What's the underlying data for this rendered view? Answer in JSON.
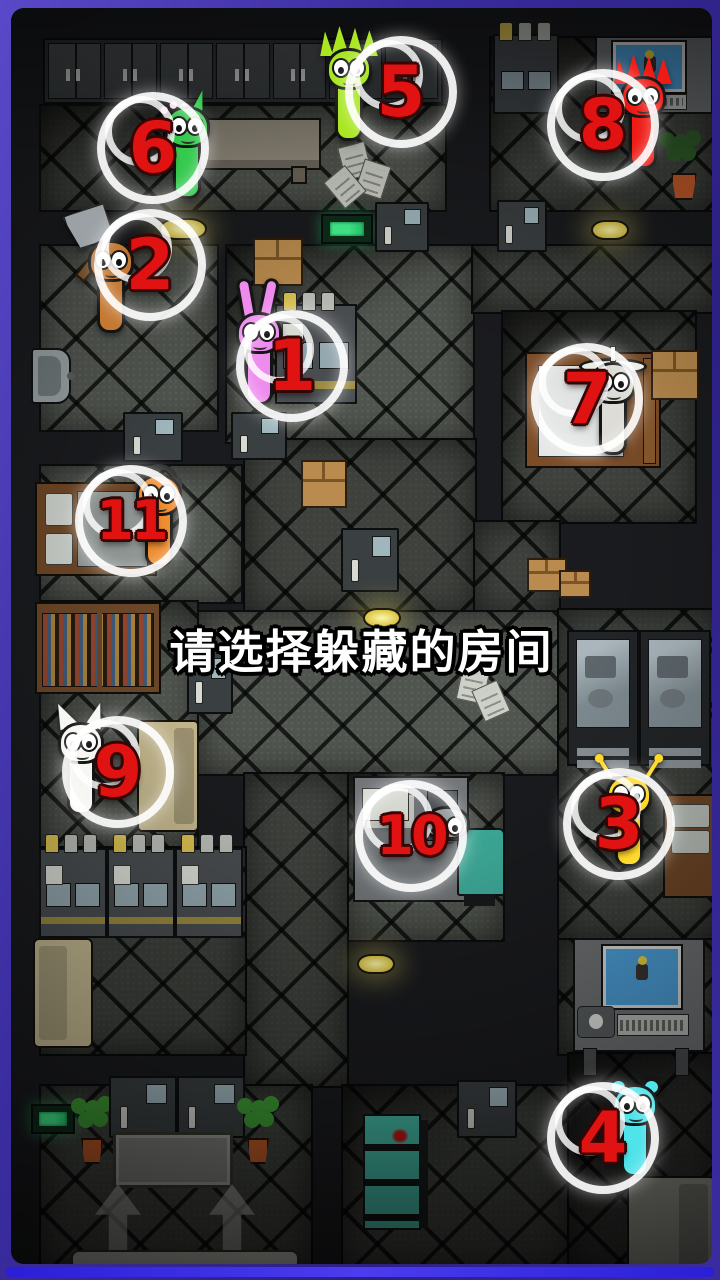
{
  "prompt": {
    "text": "请选择躲藏的房间"
  },
  "ui_colors": {
    "number": "#e01212",
    "selection_ring": "#ffffff",
    "frame_border": "#4534b4",
    "bottom_bar": "#3a2ce8",
    "exit_sign": "#45f792",
    "ceiling_lamp": "#ecd94e"
  },
  "markers": [
    {
      "number": "1",
      "character": {
        "type": "bunny",
        "color": "#ee8cee",
        "x": 222,
        "y": 304
      },
      "ring": {
        "x": 281,
        "y": 358
      }
    },
    {
      "number": "2",
      "character": {
        "type": "axe",
        "color": "#c47832",
        "x": 74,
        "y": 232
      },
      "ring": {
        "x": 139,
        "y": 257
      }
    },
    {
      "number": "3",
      "character": {
        "type": "antennae",
        "color": "#ffd928",
        "x": 592,
        "y": 766
      },
      "ring": {
        "x": 608,
        "y": 816
      }
    },
    {
      "number": "4",
      "character": {
        "type": "bear",
        "color": "#4fe3ea",
        "x": 598,
        "y": 1076
      },
      "ring": {
        "x": 592,
        "y": 1130
      }
    },
    {
      "number": "5",
      "character": {
        "type": "spiky",
        "color": "#a8e620",
        "x": 312,
        "y": 40
      },
      "ring": {
        "x": 390,
        "y": 84
      }
    },
    {
      "number": "6",
      "character": {
        "type": "flower",
        "color": "#35c94e",
        "x": 150,
        "y": 98
      },
      "ring": {
        "x": 142,
        "y": 140
      }
    },
    {
      "number": "7",
      "character": {
        "type": "hat",
        "color": "#dddcd6",
        "x": 576,
        "y": 354
      },
      "ring": {
        "x": 576,
        "y": 391
      }
    },
    {
      "number": "8",
      "character": {
        "type": "spiky",
        "color": "#ee1b15",
        "x": 606,
        "y": 68
      },
      "ring": {
        "x": 592,
        "y": 117
      }
    },
    {
      "number": "9",
      "character": {
        "type": "cat",
        "color": "#f6f6f2",
        "x": 44,
        "y": 714
      },
      "ring": {
        "x": 107,
        "y": 764
      }
    },
    {
      "number": "10",
      "character": {
        "type": "peek",
        "color": "#959a9c",
        "x": 410,
        "y": 798
      },
      "ring": {
        "x": 400,
        "y": 828
      }
    },
    {
      "number": "11",
      "character": {
        "type": "headphones",
        "color": "#ef8c2e",
        "x": 122,
        "y": 466
      },
      "ring": {
        "x": 120,
        "y": 513
      }
    }
  ]
}
